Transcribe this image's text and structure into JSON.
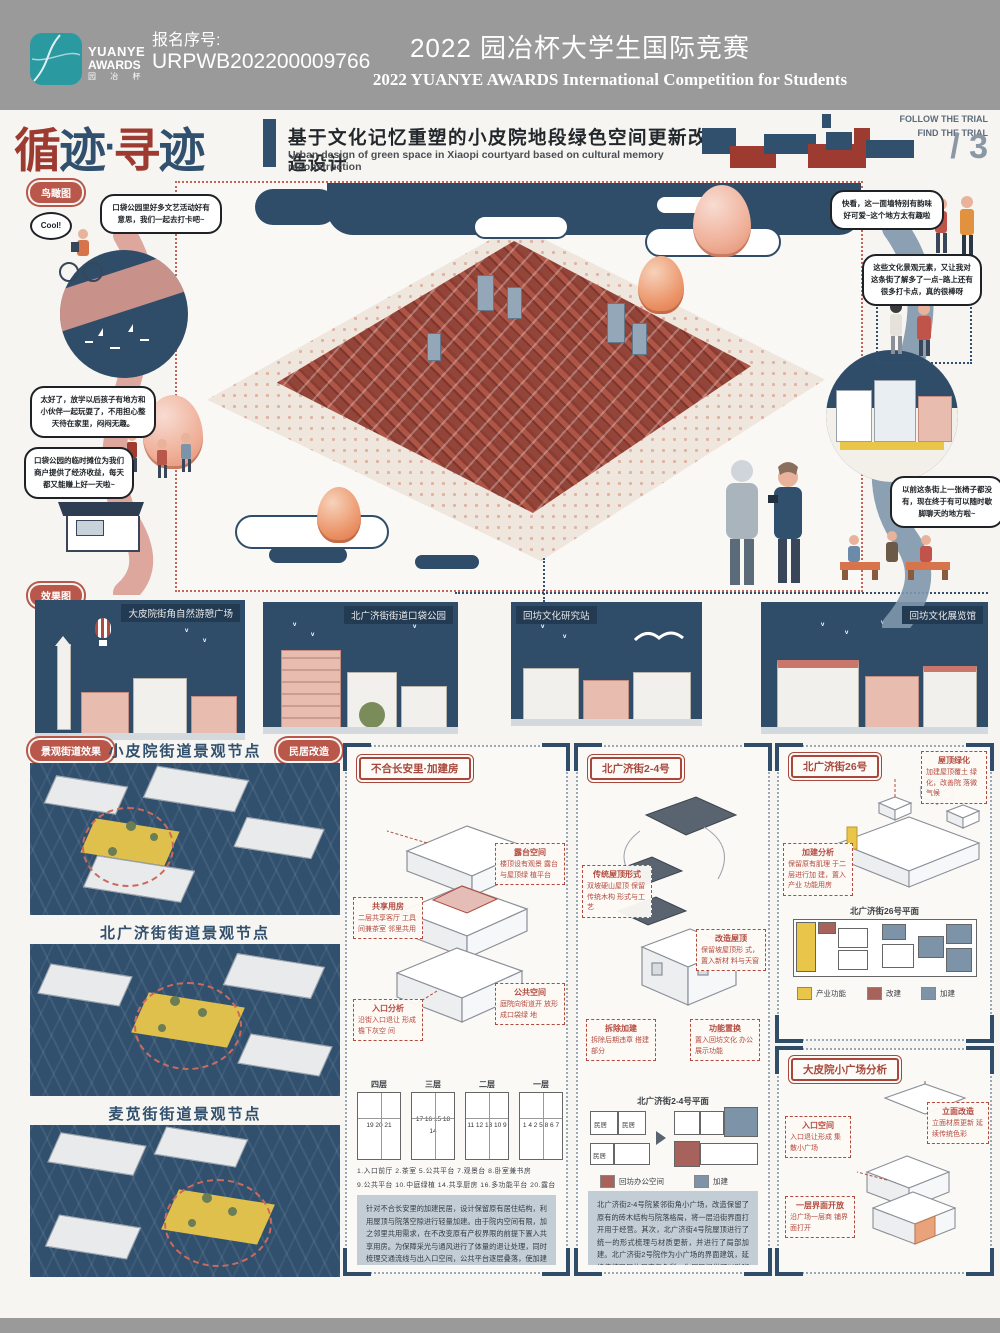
{
  "header": {
    "logo1": "YUANYE",
    "logo2": "AWARDS",
    "logo3": "园 冶 杯",
    "reg_label": "报名序号:",
    "reg_number": "URPWB202200009766",
    "title_cn": "2022 园冶杯大学生国际竞赛",
    "title_en": "2022 YUANYE AWARDS International Competition for  Students"
  },
  "titlebar": {
    "brand_chars": [
      "循",
      "迹",
      "·",
      "寻",
      "迹"
    ],
    "main_title": "基于文化记忆重塑的小皮院地段绿色空间更新改造设计",
    "sub_title": "Urban design of green space in Xiaopi courtyard based on cultural memory reconstruction",
    "follow": "FOLLOW THE TRIAL",
    "find": "FIND THE TRIAL",
    "page": "/ 3"
  },
  "badges": {
    "birdseye": "鸟瞰图",
    "renderings": "效果图",
    "street_effect": "景观街道效果",
    "dwelling_reno": "民居改造"
  },
  "bubbles": {
    "cool": "Cool!",
    "b1": "口袋公园里好多文艺活动好有意思，我们一起去打卡吧~",
    "b2": "太好了，放学以后孩子有地方和小伙伴一起玩耍了，不用担心整天待在家里，闷闷无趣。",
    "b3": "口袋公园的临时摊位为我们商户提供了经济收益，每天都又能赚上好一天啦~",
    "b4": "快看，这一面墙特别有韵味好可爱~这个地方太有趣啦",
    "b5": "这些文化景观元素，又让我对这条街了解多了一点~路上还有很多打卡点，真的很棒呀",
    "b6": "以前这条街上一张椅子都没有，现在终于有可以随时歇脚聊天的地方啦~"
  },
  "renderings": [
    {
      "label": "大皮院街角自然游憩广场"
    },
    {
      "label": "北广济街街道口袋公园"
    },
    {
      "label": "回坊文化研究站"
    },
    {
      "label": "回坊文化展览馆"
    }
  ],
  "left_sections": [
    {
      "title": "小皮院街道景观节点"
    },
    {
      "title": "北广济街街道景观节点"
    },
    {
      "title": "麦苋街街道景观节点"
    }
  ],
  "panel_infill": {
    "header": "不合长安里·加建房",
    "anns": [
      {
        "t": "共享用房",
        "b": "二层共享客厅 工具间兼茶室 邻里共用"
      },
      {
        "t": "露台空间",
        "b": "楼顶设有观景 露台与屋顶绿 植平台"
      },
      {
        "t": "公共空间",
        "b": "庭院向街道开 放形成口袋绿 地"
      },
      {
        "t": "入口分析",
        "b": "沿街入口退让 形成檐下灰空 间"
      }
    ],
    "floors": [
      {
        "label": "四层",
        "nums": "19 20 21"
      },
      {
        "label": "三层",
        "nums": "17 16 15 18 14"
      },
      {
        "label": "二层",
        "nums": "11 12 13 10 9"
      },
      {
        "label": "一层",
        "nums": "1 4 2 5 8 6 7"
      }
    ],
    "legend_row1": "1.入口前厅  2.茶室  5.公共平台  7.观景台  8.卧室兼书房",
    "legend_row2": "9.公共平台  10.中庭绿植  14.共享厨房  16.多功能平台  20.露台",
    "para": "针对不合长安里的加建民居，设计保留原有居住结构，利用屋顶与院落空隙进行轻量加建。由于院内空间有限，加之邻里共用需求，在不改变原有产权界限的前提下置入共享用房。为保障采光与通风进行了体量的退让处理，同时梳理交通流线与出入口空间，公共平台逐层叠落，使加建部分与原有街巷肌理形成连续的过渡界面，唤醒居民的集体记忆。"
  },
  "panel_courtyard2": {
    "header": "北广济街2-4号",
    "anns": [
      {
        "t": "传统屋顶形式",
        "b": "双坡硬山屋顶 保留传统木构 形式与工艺"
      },
      {
        "t": "改造屋顶",
        "b": "保留坡屋顶形 式，置入新材 料与天窗"
      },
      {
        "t": "拆除加建",
        "b": "拆除后期违章 搭建部分"
      },
      {
        "t": "功能置换",
        "b": "置入回坊文化 办公展示功能"
      }
    ],
    "plan_title": "北广济街2-4号平面",
    "room_label": "民居",
    "legend": [
      {
        "label": "回坊办公空间",
        "color": "#a8625c"
      },
      {
        "label": "加建",
        "color": "#7d93a8"
      }
    ],
    "para": "北广济街2-4号院紧邻街角小广场，改造保留了原有的砖木结构与院落格局，将一层沿街界面打开用于经营。其次，北广济街4号院屋顶进行了统一的形式梳理与材质更新，并进行了局部加建。北广济街2号院作为小广场的界面建筑，延续传统民居的尺度与色彩，为居民提供可以歇脚聊天的檐下灰空间。同时打开内部庭院与公众共享，居民与游客在此相遇，承载回坊记忆的老院落由此焕发新的活力，吸引更多年轻人。"
  },
  "panel_no26": {
    "header": "北广济街26号",
    "anns": [
      {
        "t": "加建分析",
        "b": "保留原有肌理 于二层进行加 建，置入产业 功能用房"
      },
      {
        "t": "屋顶绿化",
        "b": "加建屋顶覆土 绿化，改善院 落微气候"
      }
    ],
    "plan_title": "北广济街26号平面",
    "legend": [
      {
        "label": "产业功能",
        "color": "#e9c64a"
      },
      {
        "label": "改建",
        "color": "#a8625c"
      },
      {
        "label": "加建",
        "color": "#7d93a8"
      }
    ]
  },
  "panel_square": {
    "header": "大皮院小广场分析",
    "anns": [
      {
        "t": "入口空间",
        "b": "入口退让形成 集散小广场"
      },
      {
        "t": "立面改造",
        "b": "立面材质更新 延续传统色彩"
      },
      {
        "t": "一层界面开放",
        "b": "沿广场一层商 铺界面打开"
      }
    ]
  },
  "colors": {
    "navy": "#31506e",
    "brick": "#9e3b30",
    "teal": "#2a9aa0",
    "accent_yellow": "#e9c64a",
    "header_gray": "#9a9a9a"
  }
}
